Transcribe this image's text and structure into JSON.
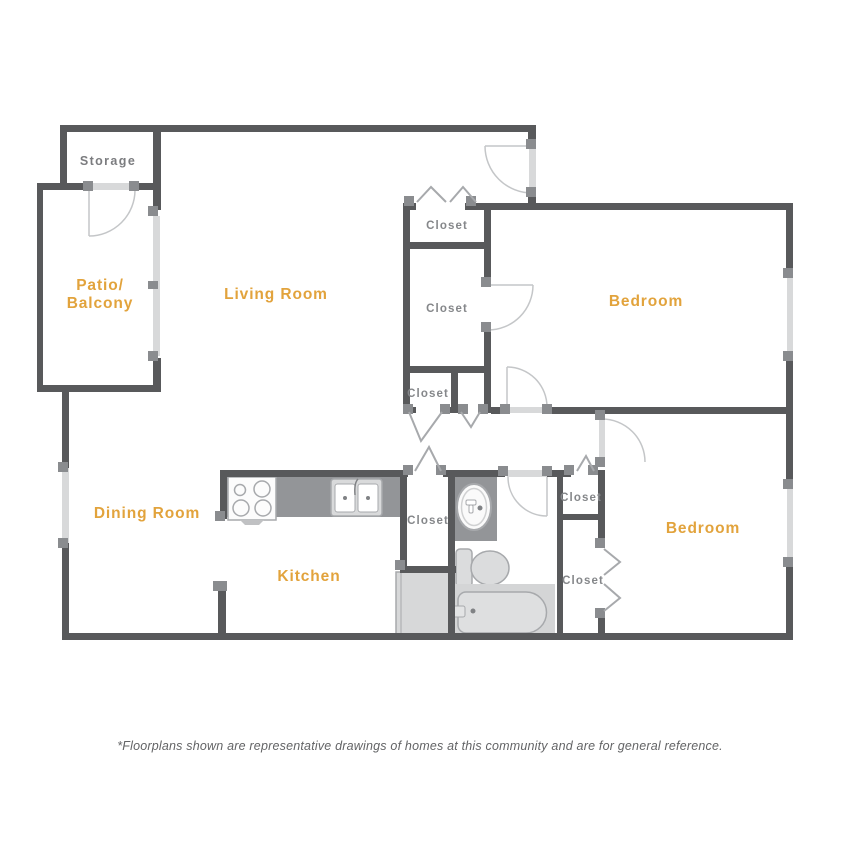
{
  "floorplan": {
    "rooms": [
      {
        "name": "storage",
        "label": "Storage"
      },
      {
        "name": "patio-balcony",
        "label_lines": [
          "Patio/",
          "Balcony"
        ]
      },
      {
        "name": "living-room",
        "label": "Living Room"
      },
      {
        "name": "dining-room",
        "label": "Dining Room"
      },
      {
        "name": "kitchen",
        "label": "Kitchen"
      },
      {
        "name": "bedroom-1",
        "label": "Bedroom"
      },
      {
        "name": "bedroom-2",
        "label": "Bedroom"
      }
    ],
    "closet_labels": [
      "Closet",
      "Closet",
      "Closet",
      "Closet",
      "Closet",
      "Closet"
    ],
    "fixtures": [
      "stove",
      "kitchen-sink",
      "bathroom-sink",
      "toilet",
      "bathtub",
      "refrigerator"
    ],
    "doors": [
      "entry-door",
      "storage-door",
      "patio-sliding-door",
      "bedroom-1-door",
      "bedroom-2-door",
      "bathroom-door",
      "walk-in-closet-door"
    ],
    "windows": [
      "dining-room-window",
      "bedroom-1-window",
      "bedroom-2-window"
    ]
  },
  "footer": {
    "disclaimer": "*Floorplans shown are representative drawings of homes at this community and are for general reference."
  },
  "colors": {
    "wall": "#58595B",
    "connector": "#8A8C8F",
    "door_window_slab": "#D8D9DA",
    "swing_arc": "#C4C6C8",
    "counter": "#939598",
    "fixture_stroke": "#A7A9AC",
    "room_label": "#E2A33C",
    "closet_label": "#85878A",
    "footer_text": "#636466",
    "background": "#FFFFFF"
  }
}
